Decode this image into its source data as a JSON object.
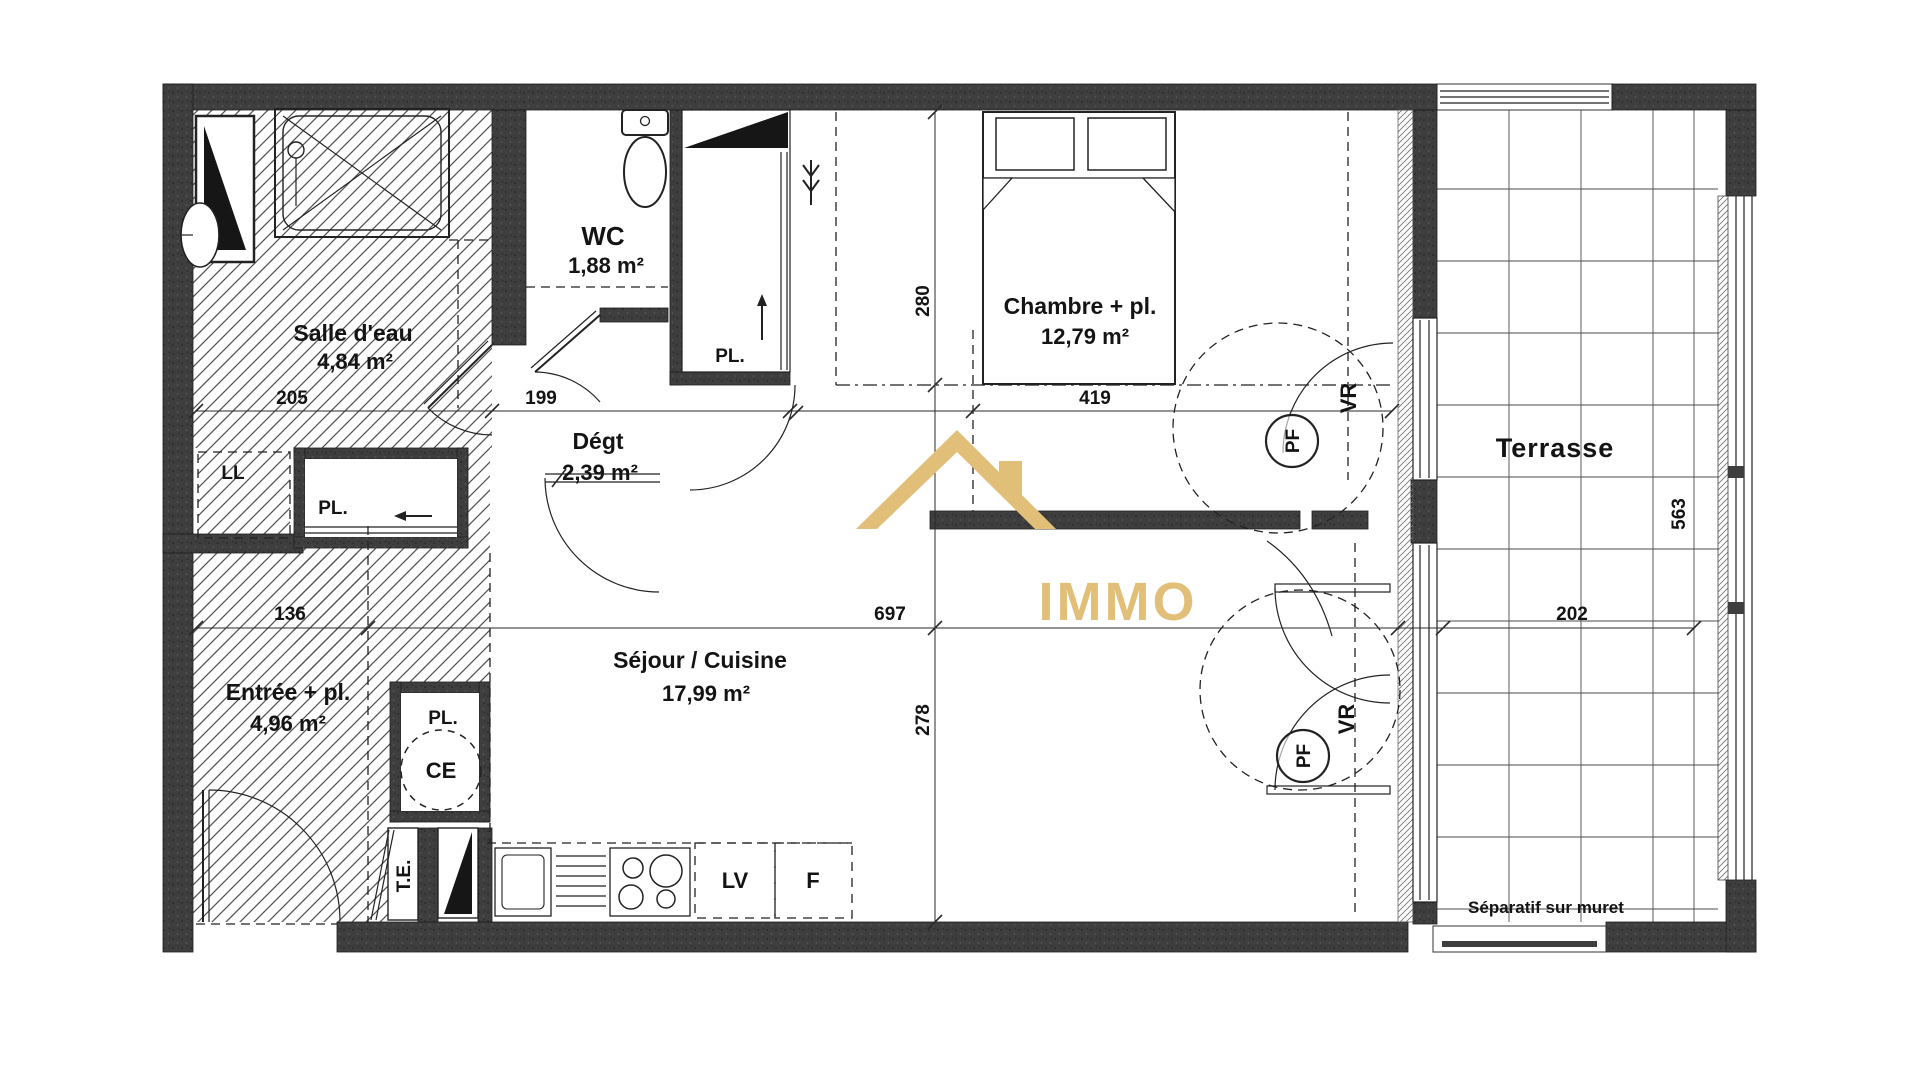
{
  "plan": {
    "brand": {
      "name": "IMMO",
      "logo": "gold-roof-house-icon",
      "color": "#e2bf78"
    },
    "rooms": {
      "salle_deau": {
        "label": "Salle d'eau",
        "area": "4,84 m²"
      },
      "wc": {
        "label": "WC",
        "area": "1,88 m²"
      },
      "degt": {
        "label": "Dégt",
        "area": "2,39 m²"
      },
      "chambre": {
        "label": "Chambre + pl.",
        "area": "12,79 m²"
      },
      "sejour": {
        "label": "Séjour / Cuisine",
        "area": "17,99 m²"
      },
      "entree": {
        "label": "Entrée + pl.",
        "area": "4,96 m²"
      },
      "terrasse": {
        "label": "Terrasse"
      }
    },
    "dims": {
      "d205": "205",
      "d199": "199",
      "d419": "419",
      "d280": "280",
      "d136": "136",
      "d697": "697",
      "d278": "278",
      "d202": "202",
      "d563": "563"
    },
    "codes": {
      "pl": "PL.",
      "ll": "LL",
      "ce": "CE",
      "te": "T.E.",
      "lv": "LV",
      "f": "F",
      "vr": "VR",
      "pf": "PF",
      "separatif": "Séparatif sur muret"
    },
    "colors": {
      "wall": "#3e3e3e",
      "accent_gold": "#e2bf78",
      "line": "#222222"
    }
  }
}
